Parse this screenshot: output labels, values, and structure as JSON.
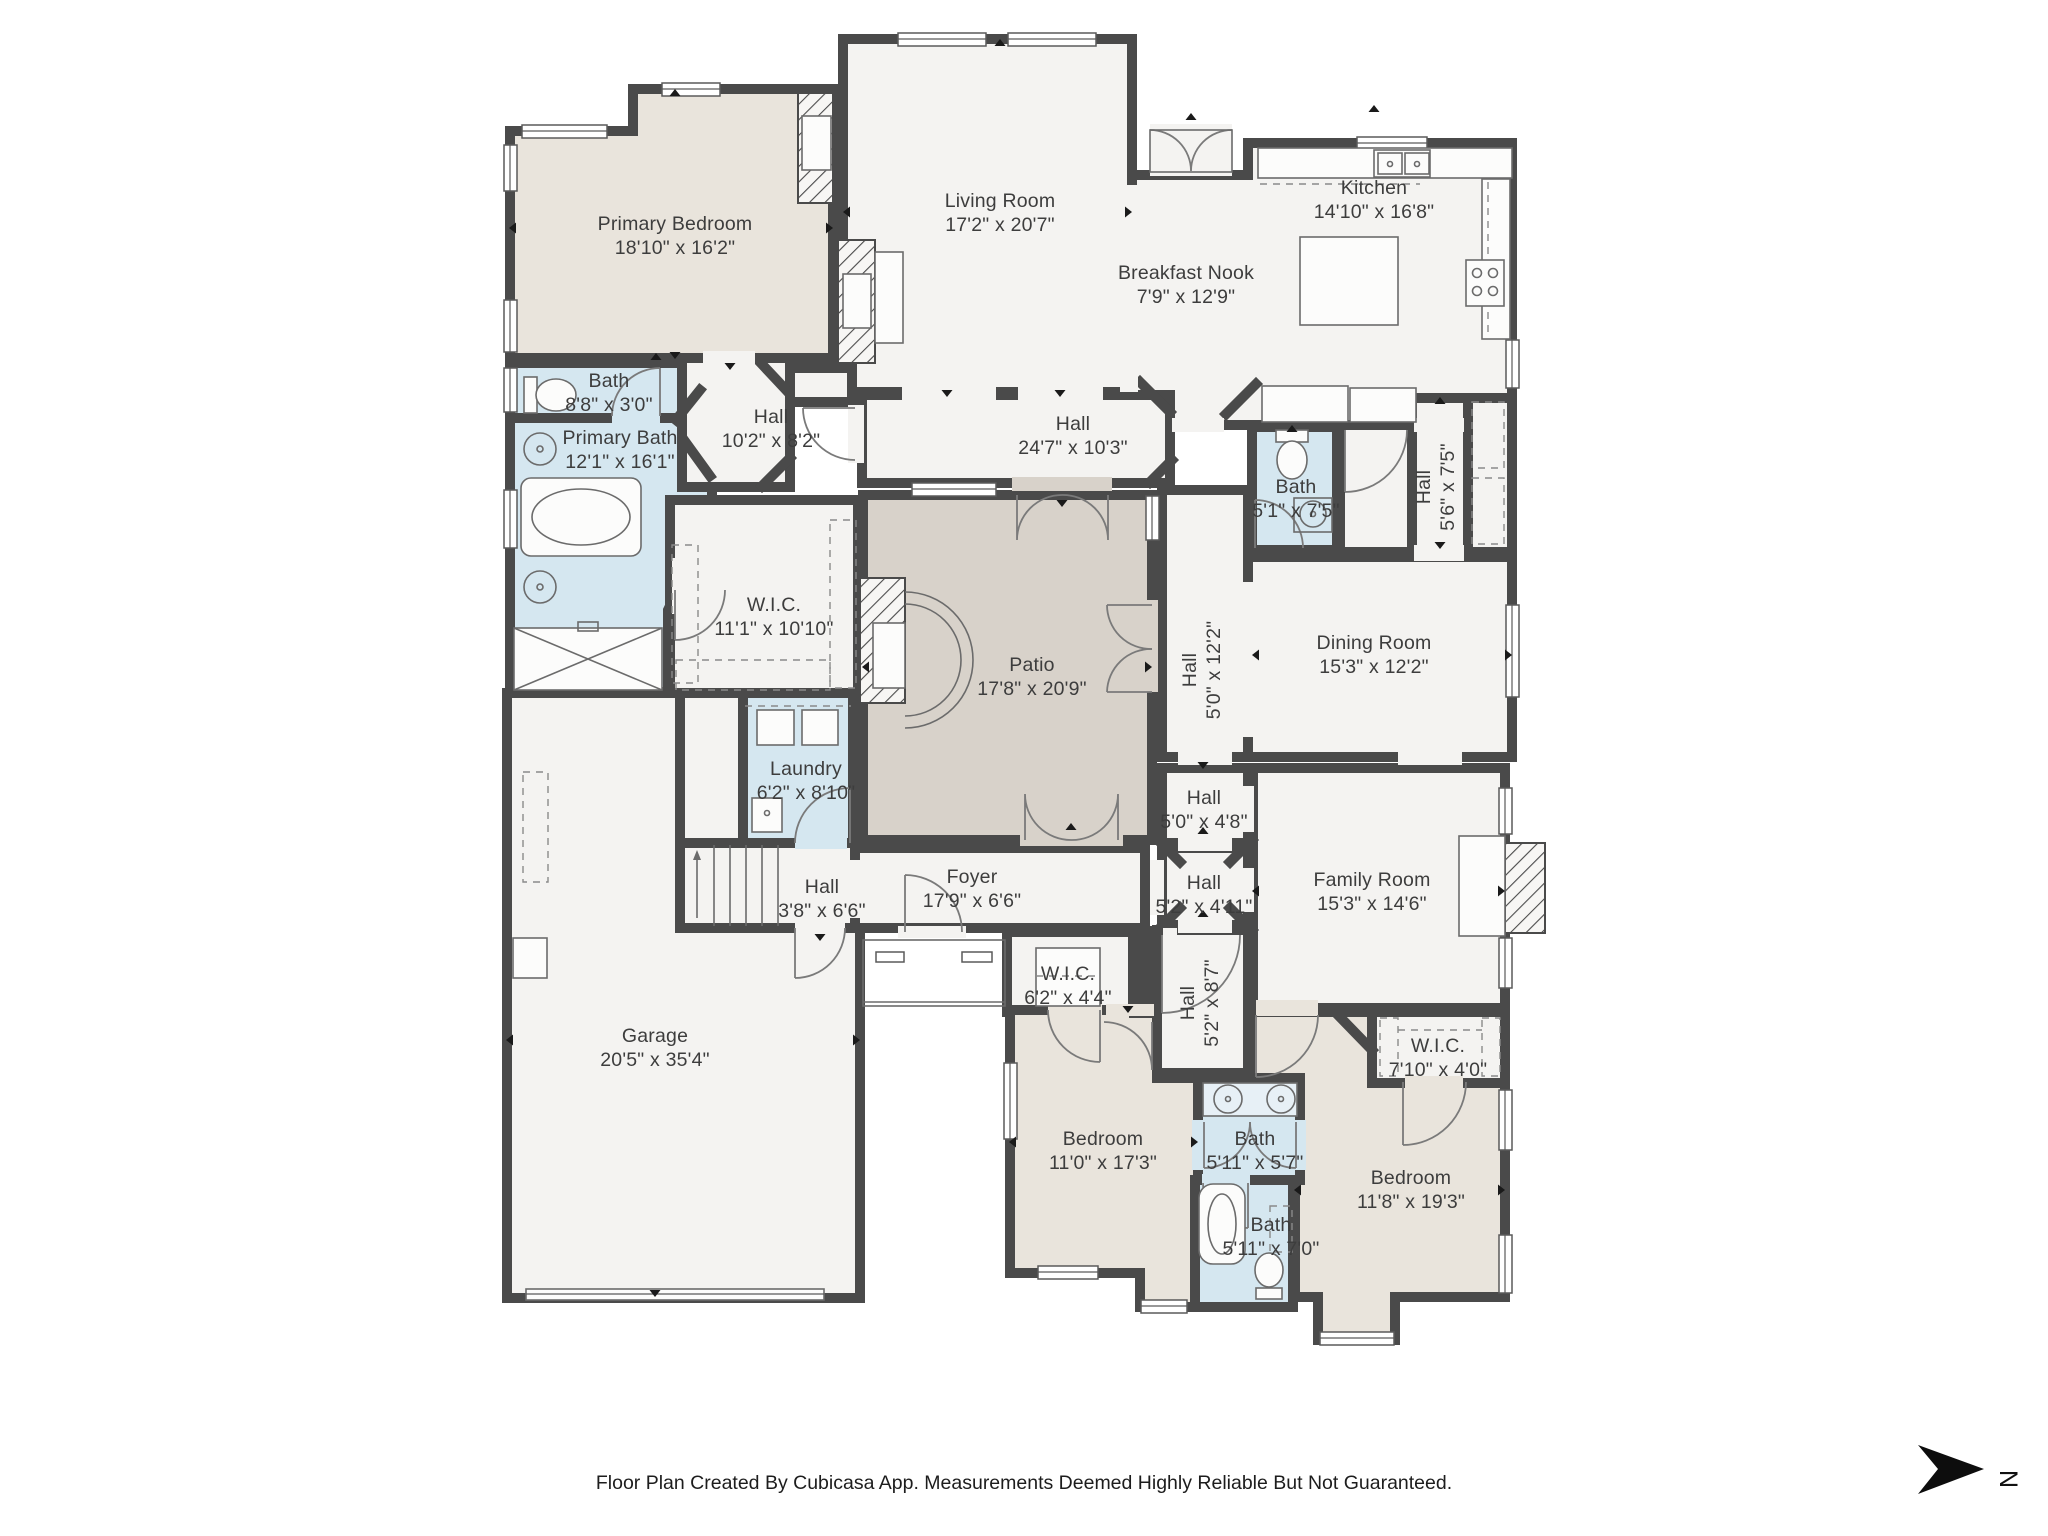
{
  "colors": {
    "wall": "#4a4a4a",
    "room_fill": "#f4f3f1",
    "bath_fill": "#d5e7f0",
    "bedroom_fill": "#e9e4dc",
    "patio_fill": "#d8d2ca",
    "vanity_fill": "#e7f0f6",
    "label": "#3d3d3d",
    "arrow": "#1a1a1a"
  },
  "rooms": [
    {
      "name": "Primary Bedroom",
      "dims": "18'10\" x 16'2\"",
      "x": 675,
      "y": 236,
      "vertical": false
    },
    {
      "name": "Living Room",
      "dims": "17'2\" x 20'7\"",
      "x": 1000,
      "y": 213,
      "vertical": false
    },
    {
      "name": "Kitchen",
      "dims": "14'10\" x 16'8\"",
      "x": 1374,
      "y": 200,
      "vertical": false
    },
    {
      "name": "Breakfast Nook",
      "dims": "7'9\" x 12'9\"",
      "x": 1186,
      "y": 285,
      "vertical": false
    },
    {
      "name": "Bath",
      "dims": "8'8\" x 3'0\"",
      "x": 609,
      "y": 393,
      "vertical": false
    },
    {
      "name": "Primary Bath",
      "dims": "12'1\" x 16'1\"",
      "x": 620,
      "y": 450,
      "vertical": false
    },
    {
      "name": "Hall",
      "dims": "10'2\" x 8'2\"",
      "x": 771,
      "y": 429,
      "vertical": false
    },
    {
      "name": "Hall",
      "dims": "24'7\" x 10'3\"",
      "x": 1073,
      "y": 436,
      "vertical": false
    },
    {
      "name": "Bath",
      "dims": "5'1\" x 7'5\"",
      "x": 1296,
      "y": 499,
      "vertical": false
    },
    {
      "name": "Hall",
      "dims": "5'6\" x 7'5\"",
      "x": 1436,
      "y": 487,
      "vertical": true
    },
    {
      "name": "W.I.C.",
      "dims": "11'1\" x 10'10\"",
      "x": 774,
      "y": 617,
      "vertical": false
    },
    {
      "name": "Patio",
      "dims": "17'8\" x 20'9\"",
      "x": 1032,
      "y": 677,
      "vertical": false
    },
    {
      "name": "Hall",
      "dims": "5'0\" x 12'2\"",
      "x": 1202,
      "y": 670,
      "vertical": true
    },
    {
      "name": "Dining Room",
      "dims": "15'3\" x 12'2\"",
      "x": 1374,
      "y": 655,
      "vertical": false
    },
    {
      "name": "Laundry",
      "dims": "6'2\" x 8'10\"",
      "x": 806,
      "y": 781,
      "vertical": false
    },
    {
      "name": "Hall",
      "dims": "5'0\" x 4'8\"",
      "x": 1204,
      "y": 810,
      "vertical": false
    },
    {
      "name": "Hall",
      "dims": "3'8\" x 6'6\"",
      "x": 822,
      "y": 899,
      "vertical": false
    },
    {
      "name": "Foyer",
      "dims": "17'9\" x 6'6\"",
      "x": 972,
      "y": 889,
      "vertical": false
    },
    {
      "name": "Hall",
      "dims": "5'2\" x 4'11\"",
      "x": 1204,
      "y": 895,
      "vertical": false
    },
    {
      "name": "Family Room",
      "dims": "15'3\" x 14'6\"",
      "x": 1372,
      "y": 892,
      "vertical": false
    },
    {
      "name": "W.I.C.",
      "dims": "6'2\" x 4'4\"",
      "x": 1068,
      "y": 986,
      "vertical": false
    },
    {
      "name": "Hall",
      "dims": "5'2\" x 8'7\"",
      "x": 1200,
      "y": 1003,
      "vertical": true
    },
    {
      "name": "W.I.C.",
      "dims": "7'10\" x 4'0\"",
      "x": 1438,
      "y": 1058,
      "vertical": false
    },
    {
      "name": "Garage",
      "dims": "20'5\" x 35'4\"",
      "x": 655,
      "y": 1048,
      "vertical": false
    },
    {
      "name": "Bedroom",
      "dims": "11'0\" x 17'3\"",
      "x": 1103,
      "y": 1151,
      "vertical": false
    },
    {
      "name": "Bath",
      "dims": "5'11\" x 5'7\"",
      "x": 1255,
      "y": 1151,
      "vertical": false
    },
    {
      "name": "Bath",
      "dims": "5'11\" x 7'0\"",
      "x": 1271,
      "y": 1237,
      "vertical": false
    },
    {
      "name": "Bedroom",
      "dims": "11'8\" x 19'3\"",
      "x": 1411,
      "y": 1190,
      "vertical": false
    }
  ],
  "footer": {
    "text": "Floor Plan Created By Cubicasa App. Measurements Deemed Highly Reliable But Not Guaranteed."
  },
  "compass": {
    "label": "N"
  }
}
